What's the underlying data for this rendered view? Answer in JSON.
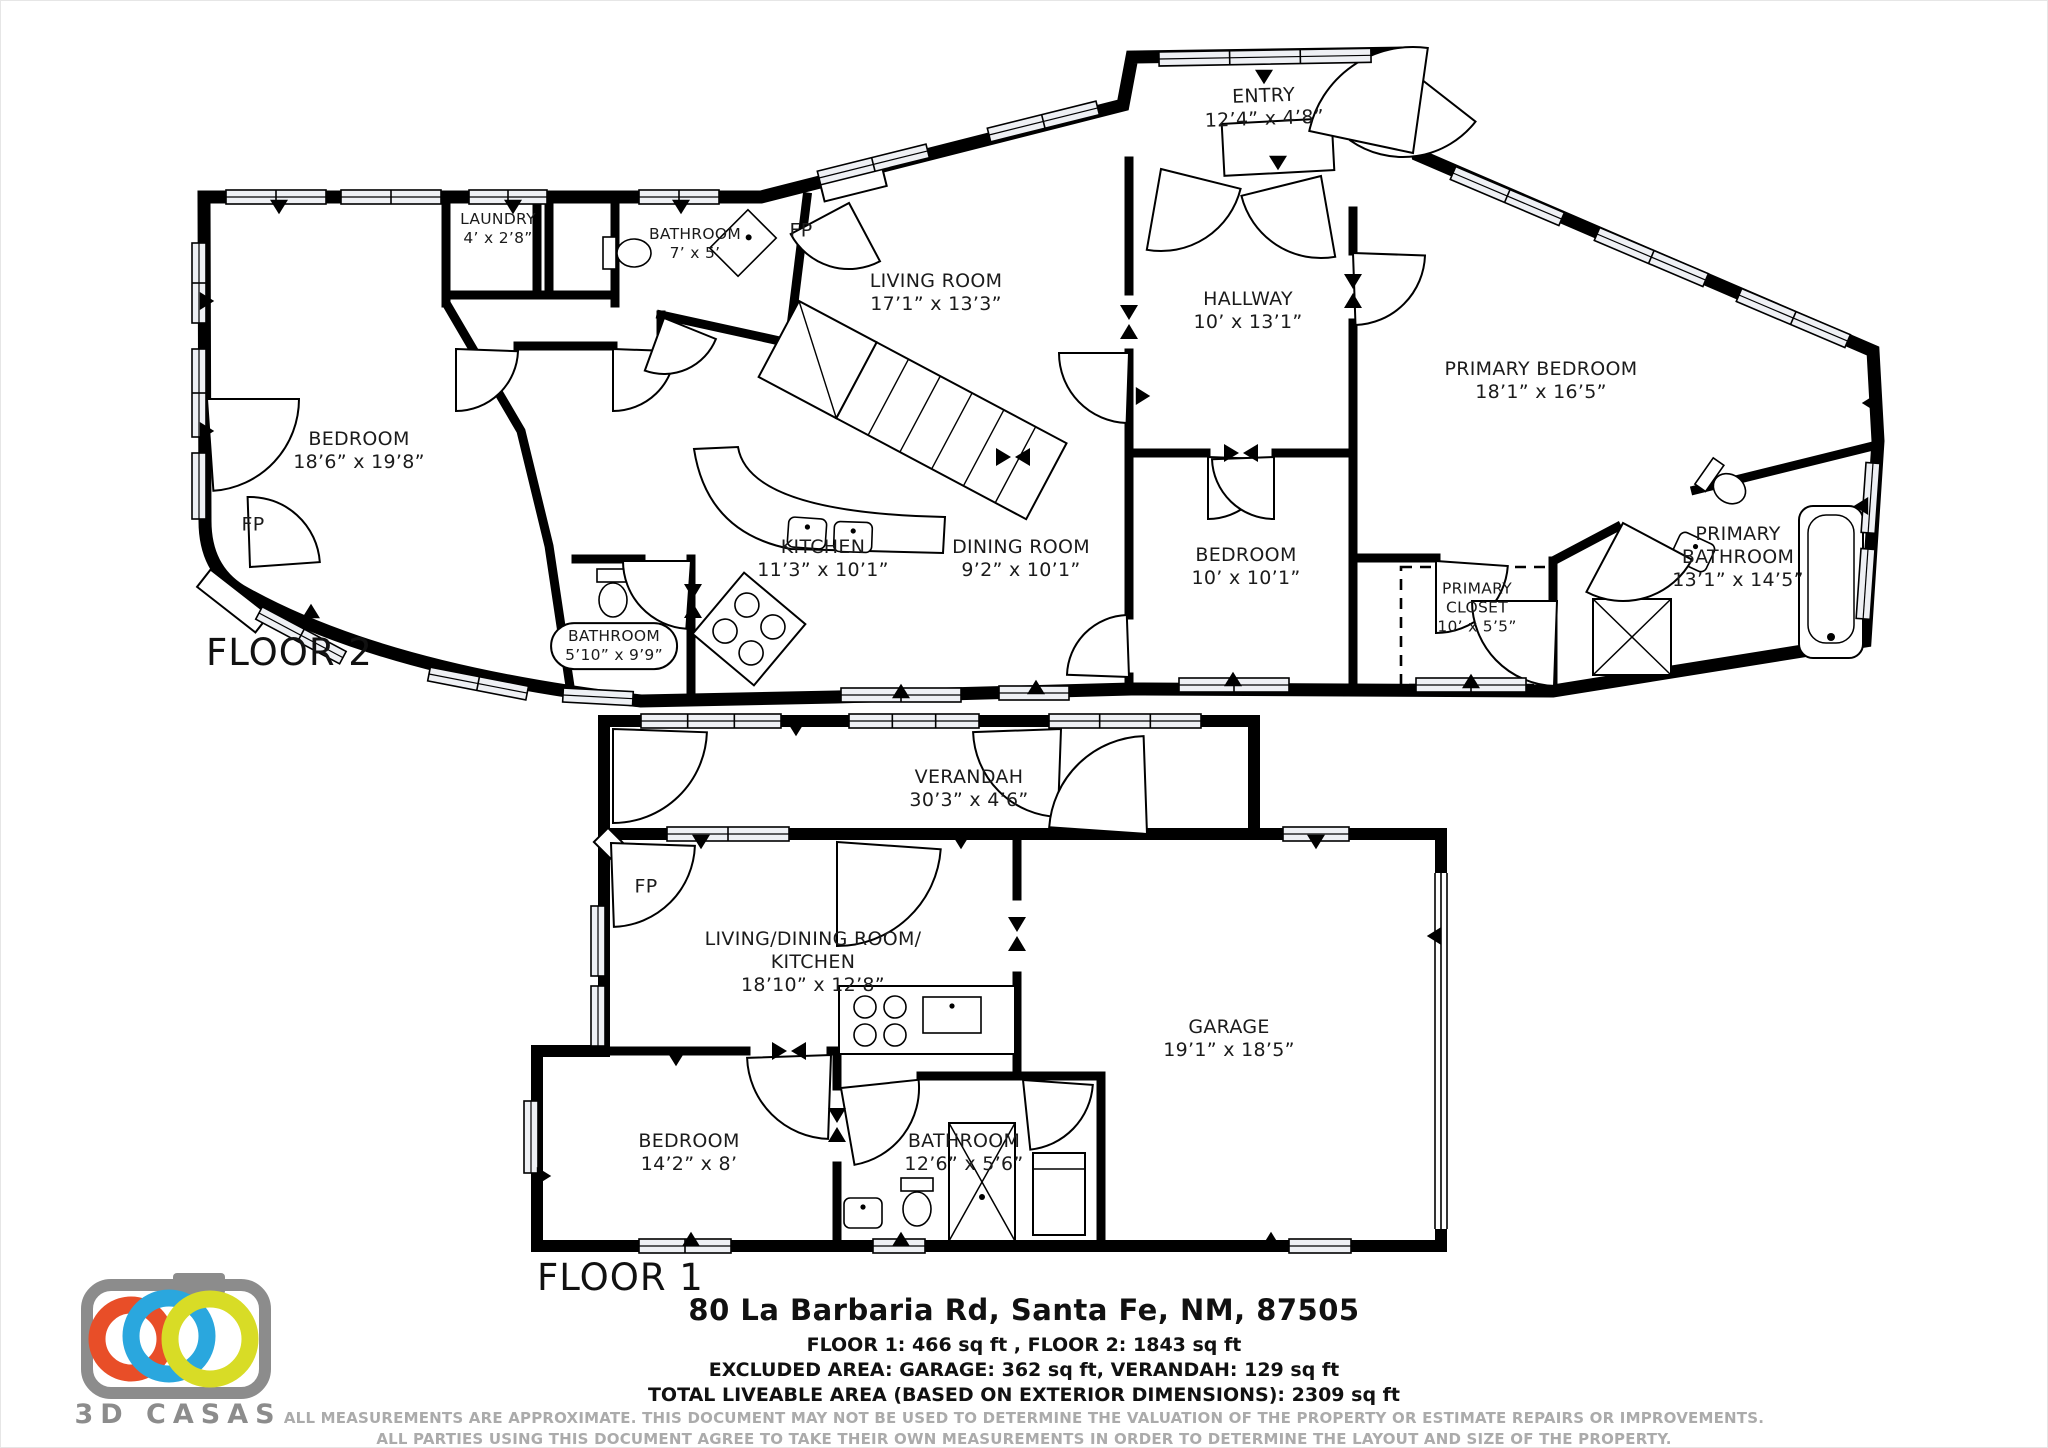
{
  "floor2": {
    "label": "FLOOR 2",
    "rooms": {
      "laundry": {
        "name": "LAUNDRY",
        "dims": "4’ x 2’8”"
      },
      "bathroom7": {
        "name": "BATHROOM",
        "dims": "7’ x 5’"
      },
      "living": {
        "name": "LIVING ROOM",
        "dims": "17’1” x 13’3”"
      },
      "entry": {
        "name": "ENTRY",
        "dims": "12’4” x 4’8”"
      },
      "hallway": {
        "name": "HALLWAY",
        "dims": "10’ x 13’1”"
      },
      "primary_bedroom": {
        "name": "PRIMARY BEDROOM",
        "dims": "18’1” x 16’5”"
      },
      "bedroom_left": {
        "name": "BEDROOM",
        "dims": "18’6” x 19’8”"
      },
      "kitchen": {
        "name": "KITCHEN",
        "dims": "11’3” x 10’1”"
      },
      "dining": {
        "name": "DINING ROOM",
        "dims": "9’2” x 10’1”"
      },
      "bedroom_mid": {
        "name": "BEDROOM",
        "dims": "10’ x 10’1”"
      },
      "primary_closet": {
        "l1": "PRIMARY",
        "l2": "CLOSET",
        "dims": "10’ x 5’5”"
      },
      "primary_bath": {
        "l1": "PRIMARY",
        "l2": "BATHROOM",
        "dims": "13’1” x 14’5”"
      },
      "bathroom510": {
        "name": "BATHROOM",
        "dims": "5’10” x 9’9”"
      }
    }
  },
  "floor1": {
    "label": "FLOOR 1",
    "rooms": {
      "verandah": {
        "name": "VERANDAH",
        "dims": "30’3” x 4’6”"
      },
      "living_dining": {
        "l1": "LIVING/DINING ROOM/",
        "l2": "KITCHEN",
        "dims": "18’10” x 12’8”"
      },
      "garage": {
        "name": "GARAGE",
        "dims": "19’1” x 18’5”"
      },
      "bedroom": {
        "name": "BEDROOM",
        "dims": "14’2” x 8’"
      },
      "bathroom": {
        "name": "BATHROOM",
        "dims": "12’6” x 5’6”"
      }
    }
  },
  "labels": {
    "fireplace": "FP"
  },
  "footer": {
    "address": "80 La Barbaria Rd, Santa Fe, NM, 87505",
    "areas1": "FLOOR 1: 466 sq ft , FLOOR 2: 1843 sq ft",
    "areas2": "EXCLUDED AREA: GARAGE: 362 sq ft, VERANDAH: 129 sq ft",
    "areas3": "TOTAL LIVEABLE AREA (BASED ON EXTERIOR DIMENSIONS): 2309 sq ft",
    "disclaimer1": "ALL MEASUREMENTS ARE APPROXIMATE. THIS DOCUMENT MAY NOT BE USED TO DETERMINE THE VALUATION OF THE PROPERTY OR ESTIMATE REPAIRS OR IMPROVEMENTS.",
    "disclaimer2": "ALL PARTIES USING THIS DOCUMENT AGREE TO TAKE THEIR OWN MEASUREMENTS IN ORDER TO DETERMINE THE LAYOUT AND SIZE OF THE PROPERTY."
  },
  "logo": {
    "brand": "3D CASAS",
    "gray": "#8c8c8c",
    "orange": "#E84E28",
    "blue": "#2AA7DE",
    "yellow": "#D8DC26"
  }
}
